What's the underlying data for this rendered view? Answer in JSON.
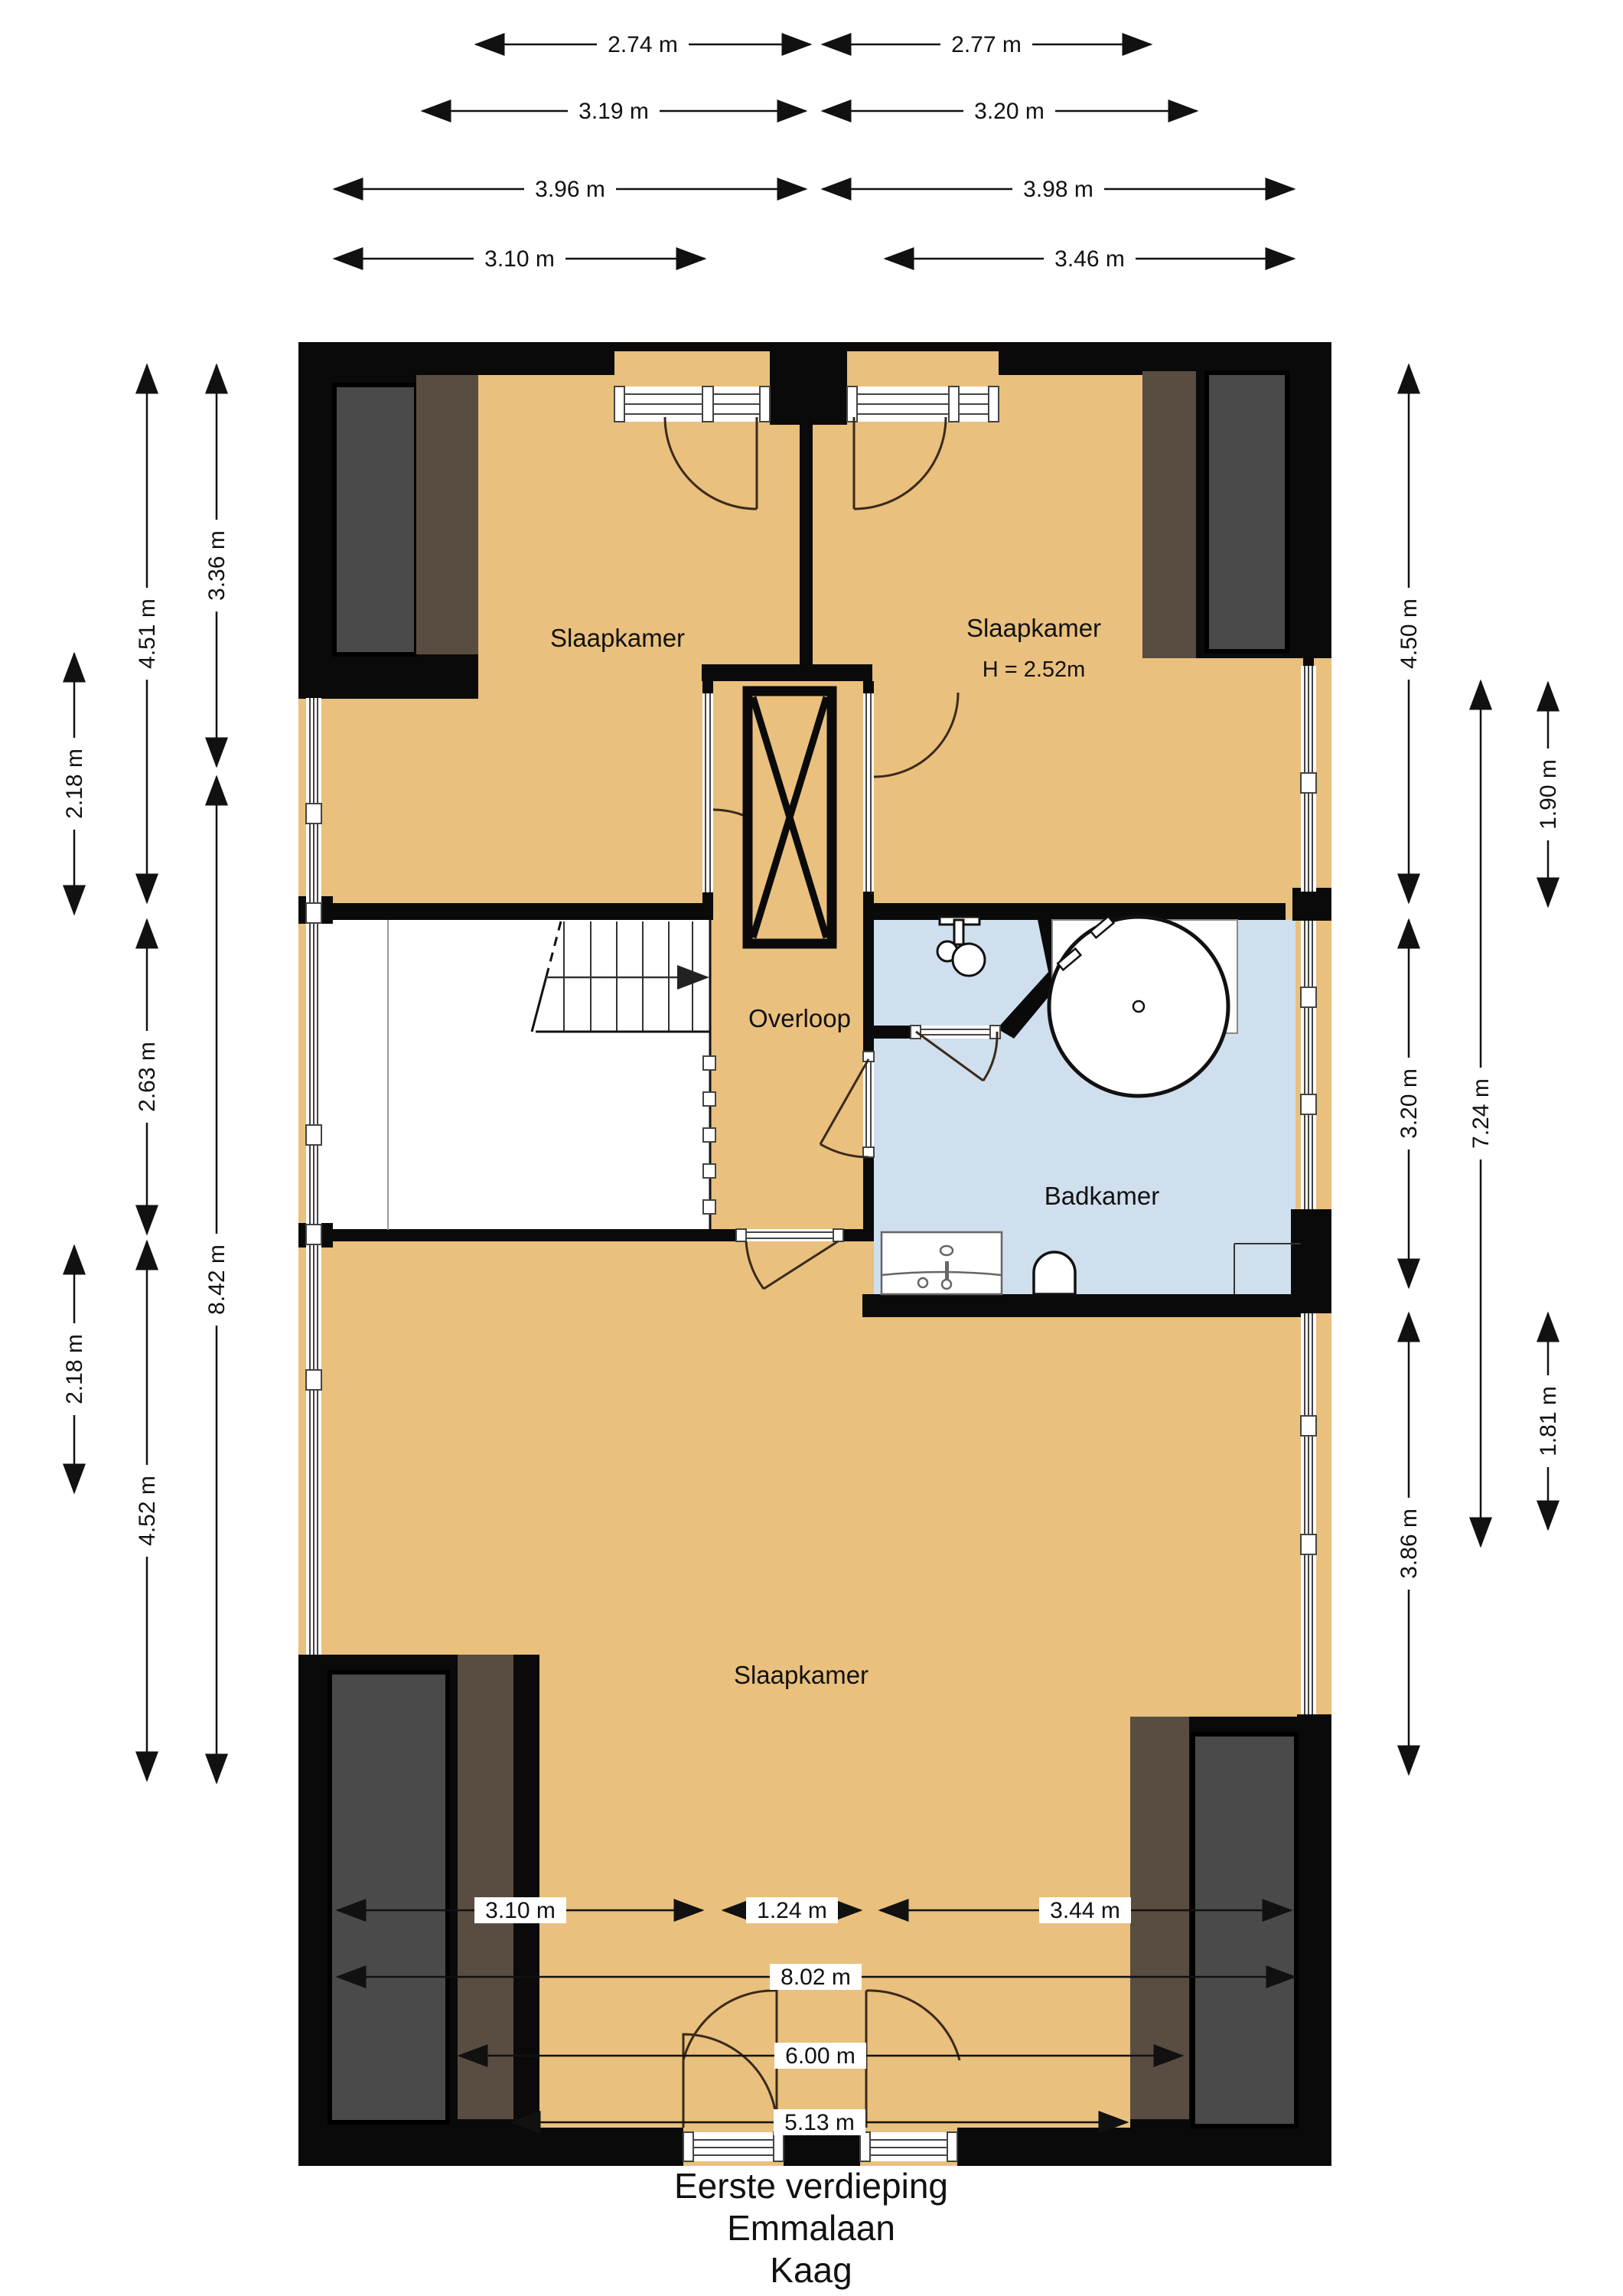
{
  "title": {
    "lines": [
      "Eerste verdieping",
      "Emmalaan",
      "Kaag"
    ]
  },
  "rooms": {
    "bedroom_top_left": "Slaapkamer",
    "bedroom_top_right": "Slaapkamer",
    "bedroom_top_right_height": "H = 2.52m",
    "landing": "Overloop",
    "bathroom": "Badkamer",
    "bedroom_bottom": "Slaapkamer"
  },
  "dims": {
    "top": [
      {
        "label": "2.74 m"
      },
      {
        "label": "2.77 m"
      },
      {
        "label": "3.19 m"
      },
      {
        "label": "3.20 m"
      },
      {
        "label": "3.96 m"
      },
      {
        "label": "3.98 m"
      },
      {
        "label": "3.10 m"
      },
      {
        "label": "3.46 m"
      }
    ],
    "bottom": [
      {
        "label": "3.10 m"
      },
      {
        "label": "1.24 m"
      },
      {
        "label": "3.44 m"
      },
      {
        "label": "8.02 m"
      },
      {
        "label": "6.00 m"
      },
      {
        "label": "5.13 m"
      }
    ],
    "left": [
      {
        "label": "2.18 m"
      },
      {
        "label": "2.18 m"
      },
      {
        "label": "4.51 m"
      },
      {
        "label": "2.63 m"
      },
      {
        "label": "4.52 m"
      },
      {
        "label": "3.36 m"
      },
      {
        "label": "8.42 m"
      }
    ],
    "right": [
      {
        "label": "4.50 m"
      },
      {
        "label": "3.20 m"
      },
      {
        "label": "3.86 m"
      },
      {
        "label": "7.24 m"
      },
      {
        "label": "1.90 m"
      },
      {
        "label": "1.81 m"
      }
    ]
  },
  "colors": {
    "floor_orange": "#e9c07d",
    "bathroom_blue": "#cfdfee",
    "wall_black": "#0a0a0a",
    "dormer_gray": "#4a4a4a",
    "dormer_brown": "#594d41"
  }
}
